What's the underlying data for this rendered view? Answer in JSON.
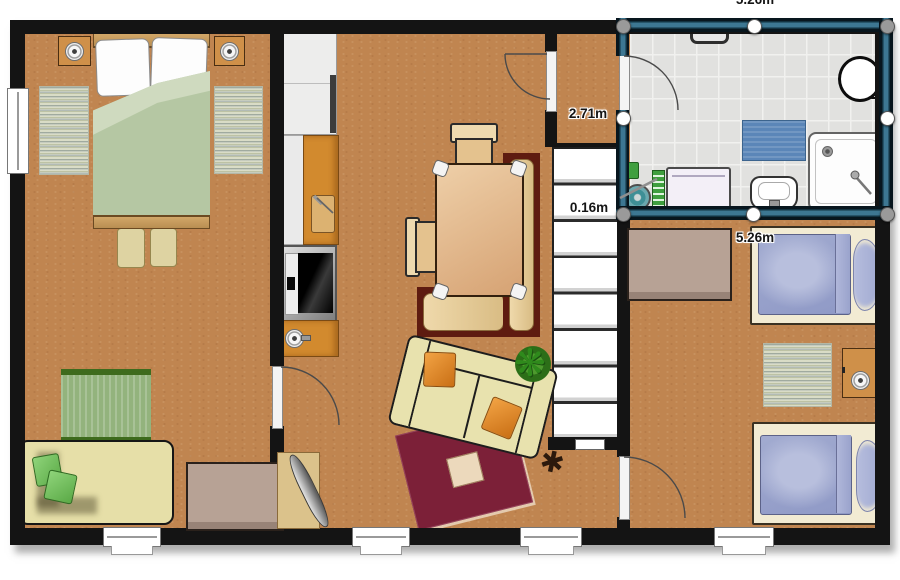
{
  "app": {
    "name": "floor-plan-editor",
    "view": "2d-plan"
  },
  "measurements": {
    "top_wall": "5.26m",
    "left_wall": "2.71m",
    "step_wall": "0.16m",
    "bottom_wall": "5.26m"
  },
  "selection": {
    "selected_object": "bathroom-room",
    "handle_corner_color": "#9a9a9a",
    "handle_midpoint_color": "#ffffff",
    "wall_highlight_color": "#3d7792"
  },
  "rooms": [
    {
      "id": "bedroom-left",
      "floor": "terracotta"
    },
    {
      "id": "living-kitchen",
      "floor": "terracotta"
    },
    {
      "id": "hallway",
      "floor": "terracotta"
    },
    {
      "id": "staircase",
      "steps": 8
    },
    {
      "id": "bathroom",
      "floor": "gray-tile",
      "selected": true
    },
    {
      "id": "bedroom-right",
      "floor": "terracotta"
    }
  ],
  "furniture": {
    "bedroom_left": [
      "double-bed",
      "nightstand-with-lamp",
      "nightstand-with-lamp",
      "bedside-rug",
      "bedside-rug",
      "pouf",
      "pouf",
      "green-striped-rug",
      "corner-sofa-with-cushions"
    ],
    "living_kitchen": [
      "kitchen-cabinets",
      "kitchen-counter-with-cutting-board",
      "stove",
      "kitchen-sink",
      "dining-table",
      "chair",
      "chair",
      "corner-bench",
      "sofa-with-pillows",
      "maroon-area-rug",
      "potted-plant",
      "coat-stand",
      "sideboard",
      "ironing-board"
    ],
    "bathroom": [
      "towel-rail",
      "toilet",
      "bath-mat",
      "washing-machine",
      "washbasin",
      "shower-tray",
      "cleaning-set"
    ],
    "bedroom_right": [
      "desk",
      "single-bed",
      "single-bed",
      "rug",
      "nightstand-with-lamp"
    ]
  },
  "openings": {
    "doors": 4,
    "windows": 5
  },
  "colors": {
    "wall_black": "#141414",
    "floor_terracotta": "#c08550",
    "bathroom_tile": "#e1e1df",
    "selection_teal": "#3d7792",
    "bed_duvet_green": "#b5c7a3",
    "single_bed_duvet_blue": "#99a2ca",
    "sofa_cream": "#e8e2ae",
    "rug_maroon": "#7c2038",
    "counter_orange": "#d28a2e",
    "bench_mahogany": "#5e1b10",
    "bath_mat_blue": "#5b86b8"
  }
}
